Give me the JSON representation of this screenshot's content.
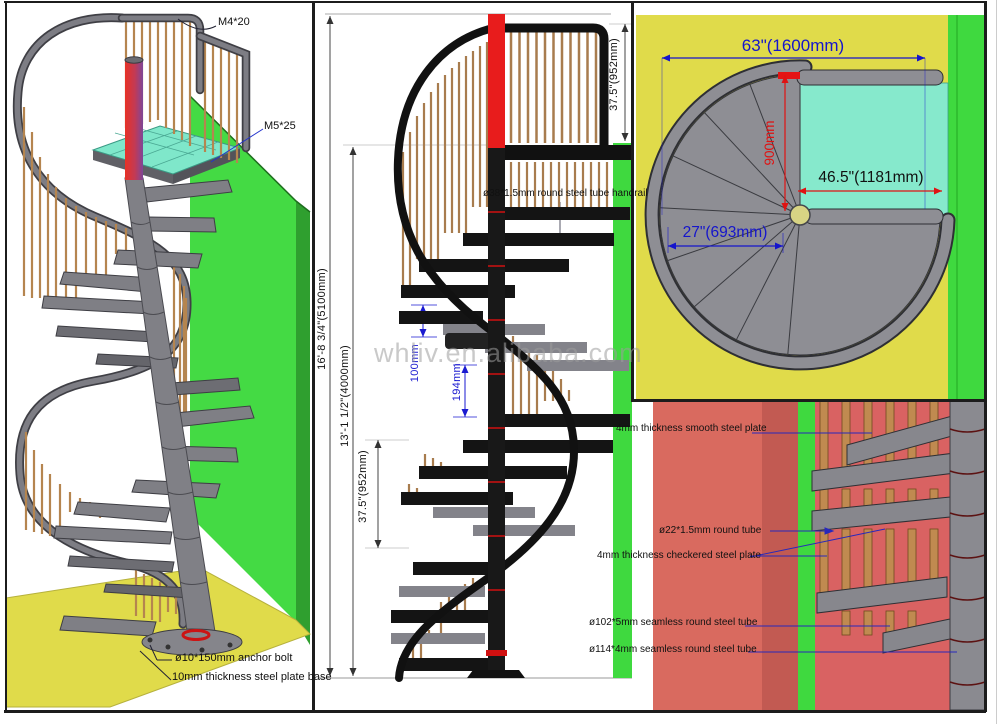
{
  "sheet": {
    "watermark": "whliv.en.alibaba.com"
  },
  "iso_view": {
    "label_m4": "M4*20",
    "label_m5": "M5*25",
    "label_anchor_bolt": "ø10*150mm anchor bolt",
    "label_base_plate": "10mm thickness steel plate base"
  },
  "elevation_view": {
    "dim_total_height": "16'-8 3/4\"(5100mm)",
    "dim_floor_to_landing": "13'-1 1/2\"(4000mm)",
    "dim_guardrail_height": "37.5\"(952mm)",
    "dim_lower_section": "37.5\"(952mm)",
    "dim_rise_100": "100mm",
    "dim_rise_194": "194mm",
    "note_handrail": "ø38*1.5mm round steel tube handrail"
  },
  "plan_view": {
    "dim_overall_width": "63\"(1600mm)",
    "dim_landing_width": "46.5\"(1181mm)",
    "dim_tread_width": "27\"(693mm)",
    "dim_landing_depth": "900mm"
  },
  "detail_view": {
    "note_smooth_plate": "4mm thickness smooth steel plate",
    "note_round_tube": "ø22*1.5mm round tube",
    "note_checkered_plate": "4mm thickness checkered steel plate",
    "note_tube_102": "ø102*5mm seamless round steel tube",
    "note_tube_114": "ø114*4mm seamless round steel tube"
  },
  "colors": {
    "floor_yellow": "#e0db4a",
    "wall_green": "#44da44",
    "landing_cyan": "#86e9cc",
    "detail_salmon": "#d96a5f",
    "detail_red": "#d96262",
    "dim_blue": "#1a1ad0",
    "dim_red": "#e01212",
    "steel_gray": "#85858b",
    "wood_tan": "#b5854f"
  }
}
